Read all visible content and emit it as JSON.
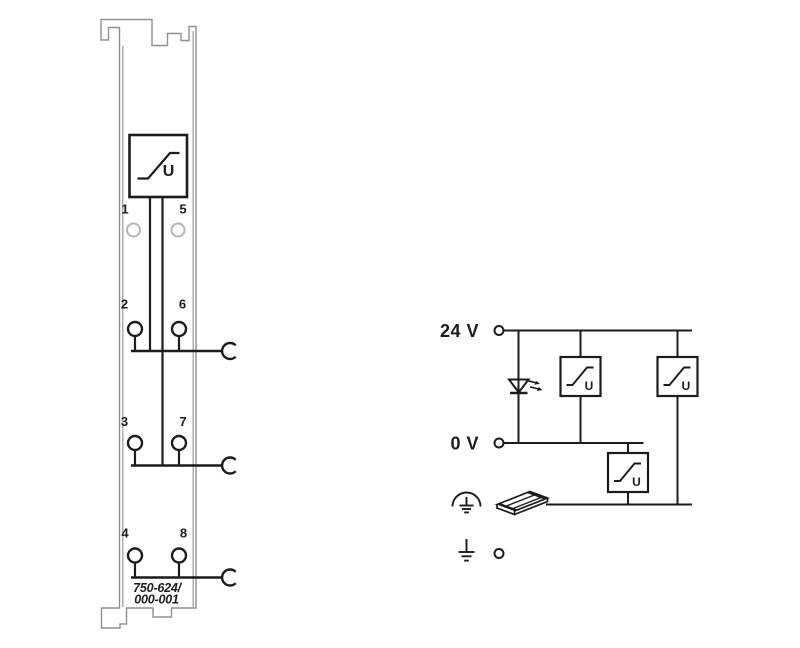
{
  "title": "WAGO 750-624/000-001 module wiring diagram",
  "colors": {
    "ink": "#1c1c1c",
    "module_outline": "#909090",
    "led_ring": "#b5b5b5",
    "background": "#ffffff"
  },
  "module": {
    "part_number_line1": "750-624/",
    "part_number_line2": "000-001",
    "filter_symbol_label": "U",
    "terminals": {
      "t1": "1",
      "t5": "5",
      "t2": "2",
      "t6": "6",
      "t3": "3",
      "t7": "7",
      "t4": "4",
      "t8": "8"
    }
  },
  "schematic": {
    "rail_24v_label": "24 V",
    "rail_0v_label": "0 V",
    "filter_symbol_label": "U"
  },
  "icons": {
    "filter": "filter-box-icon",
    "led": "led-icon",
    "clamp": "clamp-contact-icon",
    "shield": "shield-ground-icon",
    "din_rail": "din-rail-icon",
    "earth": "earth-ground-icon"
  }
}
